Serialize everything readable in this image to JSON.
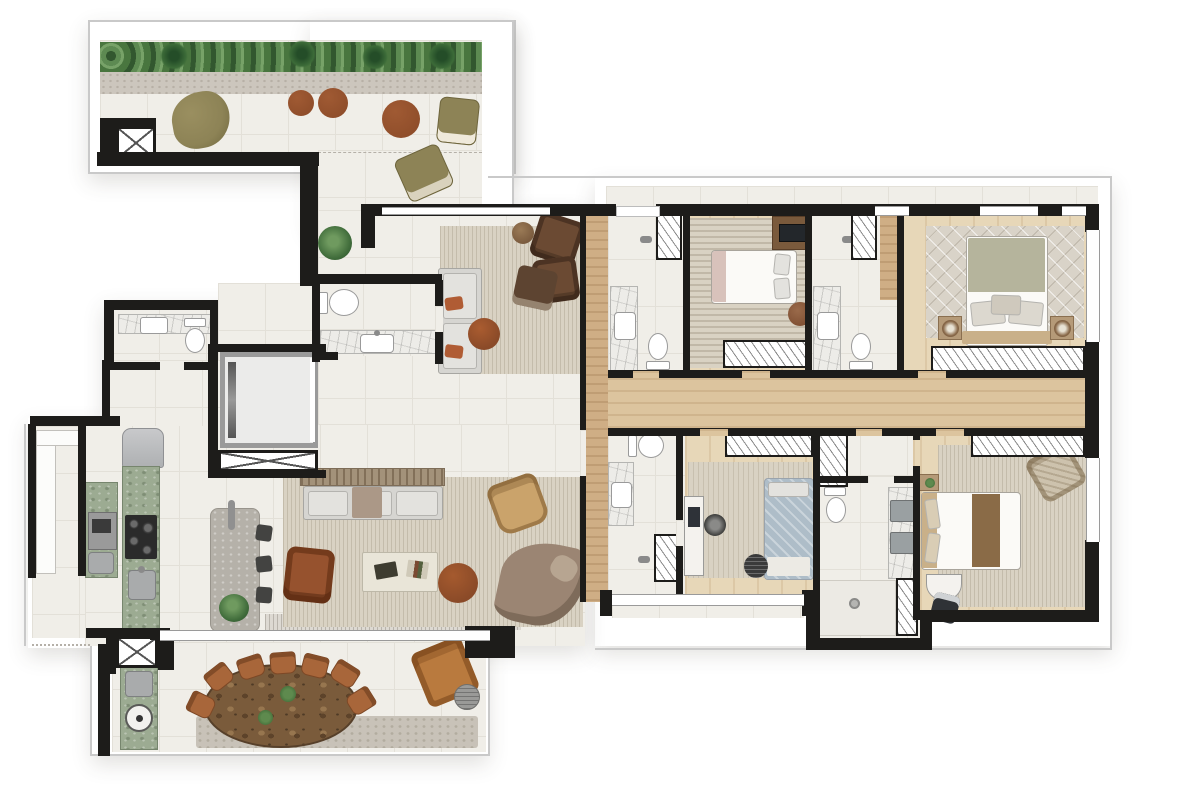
{
  "image": {
    "kind": "architectural-floor-plan-render",
    "width_px": 1200,
    "height_px": 809,
    "visible_text": "none"
  },
  "palette": {
    "wall": "#1d1c1a",
    "line": "#c9c9c9",
    "tile": "#f0eee8",
    "tileLine": "#e3e0d8",
    "wood": "#e7d7b8",
    "woodDeep": "#dcc49e",
    "woodHall": "#cfae85",
    "marble": "#edece8",
    "marbleLine": "#b5b5b2",
    "green": "#9cab92",
    "greenEdge": "#76856d",
    "island": "#b5b1a9",
    "steel": "#a9abac",
    "hedge": "#55804c",
    "hedgeDark": "#32572f",
    "gravel": "#ccc6bd",
    "stone": "#c8c2b8",
    "rug": "#d9d2c3",
    "rugDiamond": "#d9d3c8",
    "sofa": "#d6d5d1",
    "cushion": "#e3e2de",
    "leather": "#96522e",
    "cognac": "#b97a3e",
    "chair": "#a8663a",
    "chairDark": "#6b4a33",
    "ottoman": "#5d4431",
    "olive": "#8d8356",
    "pouf": "#8a4a28",
    "chaise": "#9b8573",
    "tan": "#caa36b",
    "duvet": "#fbfaf7",
    "sage": "#b5b49c",
    "headboard": "#c9b089",
    "blueBed": "#aebdc8",
    "runner": "#8a6b47",
    "tableWood": "#7a5b3b",
    "glass": "#9a9a9a",
    "hatchLine": "#8a8a8a"
  },
  "floor_plan": {
    "areas": [
      {
        "name": "roof-terrace",
        "floor": "tile",
        "features": [
          "hedge-planter-strip",
          "gravel-strip",
          "service-elevator-shaft",
          "bean-bag",
          "2-small-poufs",
          "large-pouf",
          "lounge-chair",
          "accent-chair",
          "potted-plant"
        ]
      },
      {
        "name": "sitting-room",
        "floor": "tile",
        "features": [
          "striped-rug",
          "two-seat-sofa",
          "2-armchairs",
          "square-ottoman",
          "round-pouf",
          "side-table"
        ]
      },
      {
        "name": "powder-room",
        "floor": "tile",
        "features": [
          "toilet",
          "marble-vanity-with-sink"
        ]
      },
      {
        "name": "guest-wc",
        "floor": "tile",
        "features": [
          "toilet",
          "marble-vanity-with-sink"
        ]
      },
      {
        "name": "private-elevator-hall",
        "floor": "tile",
        "features": [
          "elevator-car",
          "shaft-hatch"
        ]
      },
      {
        "name": "kitchen",
        "floor": "tile",
        "features": [
          "refrigerator",
          "green-stone-counter",
          "cooktop",
          "sink",
          "tall-unit-with-oven",
          "island-with-faucet",
          "3-bar-stools",
          "plant"
        ]
      },
      {
        "name": "utility-room",
        "floor": "tile",
        "features": [
          "white-counter"
        ]
      },
      {
        "name": "living-room",
        "floor": "tile",
        "features": [
          "large-striped-rug",
          "sofa-with-console",
          "leather-armchair",
          "coffee-table-with-books",
          "round-pouf",
          "curved-chaise",
          "tan-accent-chair"
        ]
      },
      {
        "name": "dining-terrace",
        "floor": "tile",
        "features": [
          "oval-dining-table",
          "7-dining-chairs",
          "2-table-plants",
          "barbecue-green-counter",
          "grill",
          "sink",
          "service-elevator-shaft",
          "lounge-armchair",
          "round-side-table",
          "stone-strip"
        ]
      },
      {
        "name": "entry-hallway",
        "floor": "wood"
      },
      {
        "name": "bedroom-corridor",
        "floor": "wood"
      },
      {
        "name": "bedroom-1",
        "floor": "wood",
        "features": [
          "striped-rug",
          "double-bed",
          "tv-cabinet",
          "round-stool",
          "wardrobe"
        ]
      },
      {
        "name": "master-bedroom",
        "floor": "wood",
        "features": [
          "diamond-rug",
          "king-bed",
          "2-nightstands-with-lamps",
          "wardrobe-row",
          "window-wall"
        ]
      },
      {
        "name": "bedroom-2",
        "floor": "wood",
        "features": [
          "rug",
          "single-bed",
          "desk-with-monitor",
          "desk-chair",
          "round-pouf",
          "wardrobe",
          "closet-column"
        ]
      },
      {
        "name": "bedroom-3",
        "floor": "wood",
        "features": [
          "striped-rug",
          "double-bed-with-runner",
          "nightstand",
          "accent-chair",
          "desk",
          "chair",
          "wardrobe-row",
          "window-wall"
        ]
      },
      {
        "name": "bathroom-1",
        "floor": "tile",
        "features": [
          "shower-with-glass",
          "marble-vanity",
          "toilet"
        ]
      },
      {
        "name": "bathroom-2",
        "floor": "tile",
        "features": [
          "shower-with-glass",
          "marble-vanity",
          "toilet",
          "wood-bench"
        ]
      },
      {
        "name": "bathroom-3",
        "floor": "tile",
        "features": [
          "toilet",
          "double-steel-sink-vanity",
          "walk-in-shower-with-drain",
          "closet-column"
        ]
      },
      {
        "name": "bathroom-4",
        "floor": "tile",
        "features": [
          "toilet",
          "marble-vanity",
          "shower-with-glass"
        ]
      }
    ]
  }
}
